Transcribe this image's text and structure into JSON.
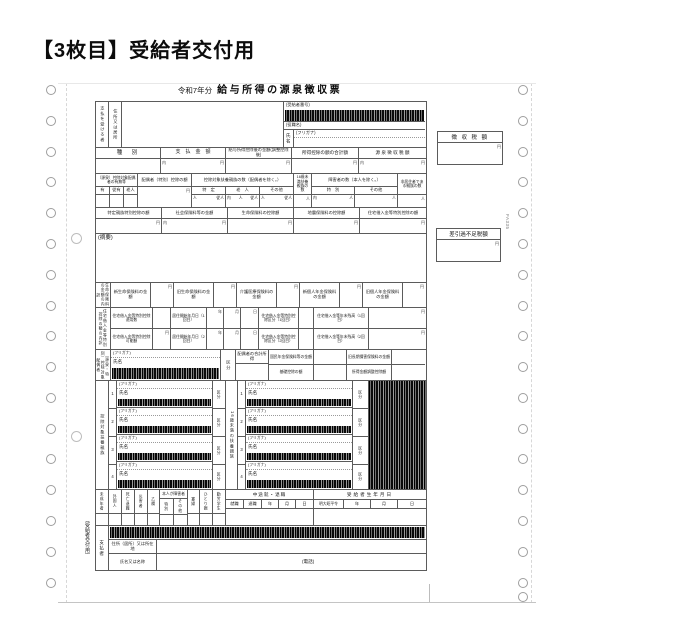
{
  "heading": "【3枚目】受給者交付用",
  "side": {
    "box1": "徴 収 税 額",
    "box2": "差引過不足税額",
    "code": "FA335"
  },
  "form": {
    "era": "令和7年分",
    "title": "給与所得の源泉徴収票",
    "payee": {
      "who": "支払を受ける者",
      "addr": "住所又は居所",
      "recno": "(受給者番号)",
      "role": "(役職名)",
      "name": "氏名",
      "kana": "(フリガナ)"
    },
    "amounts": [
      "種　別",
      "支　払　金　額",
      "給与所得控除後の金額(調整控除後)",
      "所得控除の額の合計額",
      "源 泉 徴 収 税 額"
    ],
    "counts": {
      "spouse": "（源泉）控除対象配偶者の有無等",
      "spouse_sub": [
        "有",
        "従有",
        "老人"
      ],
      "spouse_ded": "配偶者（特別）控除の額",
      "dep": "控除対象扶養親族の数（配偶者を除く。）",
      "dep_sub": [
        "特　定",
        "老　人",
        "その他"
      ],
      "u16": "16歳未満扶養親族の数",
      "dis": "障害者の数（本人を除く。）",
      "dis_sub": [
        "特　別",
        "その他"
      ],
      "nonres": "非居住者である親族の数"
    },
    "ded": [
      "特定親族特別控除の額",
      "社会保険料等の金額",
      "生命保険料の控除額",
      "地震保険料の控除額",
      "住宅借入金等特別控除の額"
    ],
    "remarks": "(摘要)",
    "life": {
      "group": "生命保険料の金額の内訳",
      "items": [
        "新生命保険料の金額",
        "旧生命保険料の金額",
        "介護医療保険料の金額",
        "新個人年金保険料の金額",
        "旧個人年金保険料の金額"
      ]
    },
    "house": {
      "group": "住宅借入金等特別控除の額の内訳",
      "r1": [
        "住宅借入金等特別控除適用数",
        "居住開始年月日（1回目）",
        "住宅借入金等特別控除区分（1回目）",
        "住宅借入金等年末残高（1回目）"
      ],
      "r2": [
        "住宅借入金等特別控除可能額",
        "居住開始年月日（2回目）",
        "住宅借入金等特別控除区分（2回目）",
        "住宅借入金等年末残高（2回目）"
      ],
      "ymd": [
        "年",
        "月",
        "日"
      ]
    },
    "spouse": {
      "group": "（源泉・特別）控除対象配偶者",
      "kana": "(フリガナ)",
      "name": "氏名",
      "kubun": "区分",
      "income": "配偶者の合計所得",
      "pension": "国民年金保険料等の金額",
      "oldins": "旧長期損害保険料の金額",
      "basic": "基礎控除の額",
      "adj": "所得金額調整控除額"
    },
    "deps": {
      "group": "控除対象扶養親族",
      "u16": "16歳未満の扶養親族",
      "kana": "(フリガナ)",
      "name": "氏名",
      "kubun": "区分",
      "nums": [
        "1",
        "2",
        "3",
        "4"
      ]
    },
    "status": {
      "c": [
        "未成年者",
        "外国人",
        "死亡退職",
        "災害者",
        "乙欄"
      ],
      "dis": "本人が障害者",
      "dis_sub": [
        "特別",
        "その他"
      ],
      "c2": [
        "寡婦",
        "ひとり親",
        "勤労学生"
      ],
      "mid": "中途就・退職",
      "mid_sub": [
        "就職",
        "退職",
        "年",
        "月",
        "日"
      ],
      "birth": "受給者生年月日",
      "birth_era": "明大昭平令",
      "birth_sub": [
        "年",
        "月",
        "日"
      ]
    },
    "payer": {
      "copy": "(受給者交付用)",
      "group": "支払者",
      "addr": "住所（居所）又は所在地",
      "name": "氏名又は名称",
      "tel": "(電話)"
    },
    "units": {
      "yen": "円",
      "uchi": "内",
      "p": "人",
      "jp": "従人"
    }
  }
}
